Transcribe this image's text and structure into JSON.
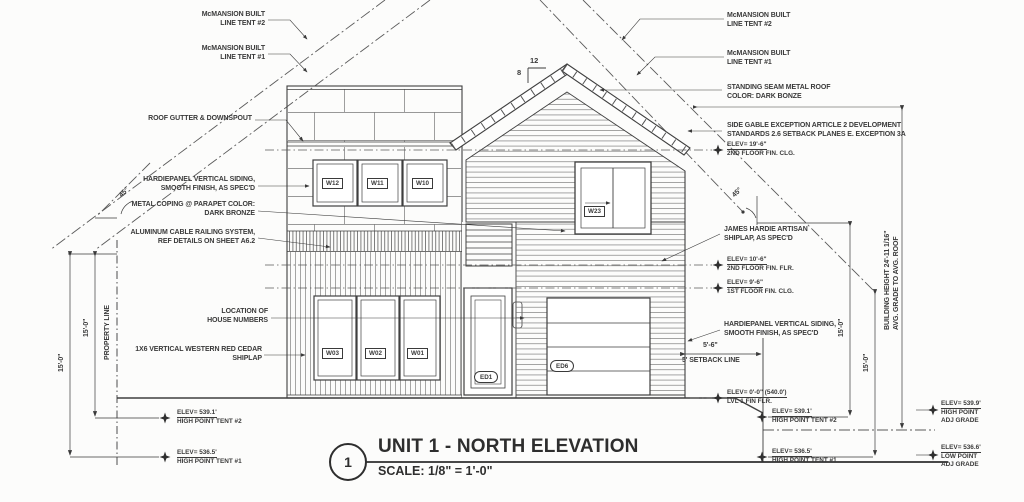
{
  "title_block": {
    "detail_number": "1",
    "title": "UNIT 1 - NORTH ELEVATION",
    "scale": "SCALE: 1/8\" = 1'-0\""
  },
  "roof_pitch": {
    "rise": "8",
    "run": "12"
  },
  "angles": {
    "left": "45°",
    "right": "45°"
  },
  "notes_left": [
    {
      "lines": [
        "McMANSION BUILT",
        "LINE TENT #2"
      ]
    },
    {
      "lines": [
        "McMANSION BUILT",
        "LINE TENT #1"
      ]
    },
    {
      "lines": [
        "ROOF GUTTER & DOWNSPOUT",
        ""
      ]
    },
    {
      "lines": [
        "HARDIEPANEL VERTICAL SIDING,",
        "SMOOTH FINISH, AS SPEC'D"
      ]
    },
    {
      "lines": [
        "METAL COPING @ PARAPET COLOR:",
        "DARK BRONZE"
      ]
    },
    {
      "lines": [
        "ALUMINUM CABLE RAILING SYSTEM,",
        "REF DETAILS ON SHEET A6.2"
      ]
    },
    {
      "lines": [
        "LOCATION OF",
        "HOUSE NUMBERS"
      ]
    },
    {
      "lines": [
        "1X6 VERTICAL WESTERN RED CEDAR",
        "SHIPLAP"
      ]
    }
  ],
  "notes_right": [
    {
      "lines": [
        "McMANSION BUILT",
        "LINE TENT #2"
      ]
    },
    {
      "lines": [
        "McMANSION BUILT",
        "LINE TENT #1"
      ]
    },
    {
      "lines": [
        "STANDING SEAM METAL ROOF",
        "COLOR: DARK BONZE"
      ]
    },
    {
      "lines": [
        "SIDE GABLE EXCEPTION ARTICLE 2 DEVELOPMENT",
        "STANDARDS 2.6 SETBACK PLANES E. EXCEPTION 3A"
      ]
    },
    {
      "lines": [
        "JAMES HARDIE ARTISAN",
        "SHIPLAP, AS SPEC'D"
      ]
    },
    {
      "lines": [
        "HARDIEPANEL VERTICAL SIDING,",
        "SMOOTH FINISH, AS SPEC'D"
      ]
    }
  ],
  "dims": {
    "d15": "15'-0\"",
    "d56": "5'-6\"",
    "setback": "5' SETBACK LINE",
    "property_line": "PROPERTY LINE",
    "building_height": [
      "BUILDING HEIGHT 24'-11 1/16\"",
      "AVG. GRADE TO AVG. ROOF"
    ]
  },
  "elevation_markers": [
    {
      "elev": "ELEV= 19'-6\"",
      "desc": "2ND FLOOR FIN. CLG."
    },
    {
      "elev": "ELEV= 10'-6\"",
      "desc": "2ND FLOOR FIN. FLR."
    },
    {
      "elev": "ELEV= 9'-6\"",
      "desc": "1ST FLOOR FIN. CLG."
    },
    {
      "elev": "ELEV= 0'-0\" (540.0')",
      "desc": "LVL 1 FIN FLR."
    },
    {
      "elev": "ELEV= 539.1'",
      "desc": "HIGH POINT TENT #2"
    },
    {
      "elev": "ELEV= 536.5'",
      "desc": "HIGH POINT TENT #1"
    },
    {
      "elev": "ELEV= 539.1'",
      "desc": "HIGH POINT TENT #2"
    },
    {
      "elev": "ELEV= 536.5'",
      "desc": "HIGH POINT TENT #1"
    },
    {
      "elev": "ELEV= 539.9'",
      "desc": "HIGH POINT",
      "desc2": "ADJ GRADE"
    },
    {
      "elev": "ELEV= 536.6'",
      "desc": "LOW POINT",
      "desc2": "ADJ GRADE"
    }
  ],
  "tags": {
    "w12": "W12",
    "w11": "W11",
    "w10": "W10",
    "w23": "W23",
    "w03": "W03",
    "w02": "W02",
    "w01": "W01",
    "ed1": "ED1",
    "ed6": "ED6"
  }
}
